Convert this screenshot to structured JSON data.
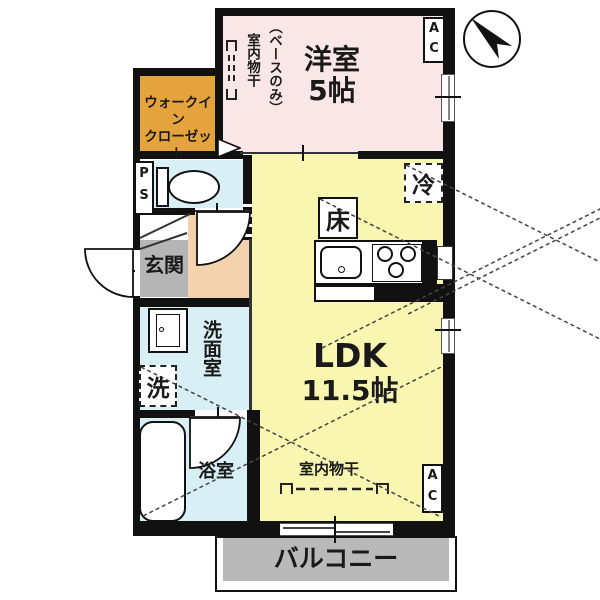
{
  "rooms": {
    "western": {
      "name": "洋室",
      "size": "5帖"
    },
    "wic": {
      "line1": "ウォークイン",
      "line2": "クローゼット"
    },
    "ldk": {
      "name": "LDK",
      "size": "11.5帖"
    },
    "entrance": {
      "name": "玄関"
    },
    "washroom": {
      "name": "洗面室"
    },
    "bathroom": {
      "name": "浴室"
    },
    "balcony": {
      "name": "バルコニー"
    }
  },
  "labels": {
    "ac": "AC",
    "ps": "PS",
    "fridge": "冷",
    "floor_storage": "床",
    "washer": "洗",
    "indoor_drying": "室内物干",
    "drying_note": "（ベースのみ）"
  },
  "icons": {
    "compass": "north-arrow-icon",
    "drying_rail": "drying-rail-icon",
    "door_swing": "door-swing-arc"
  },
  "colors": {
    "western_room": "#f9e7e7",
    "ldk": "#f8f6b0",
    "wic": "#e4a33c",
    "wet_area": "#d8f0f5",
    "hall": "#f3d3ae",
    "entrance": "#b5b5b5",
    "balcony": "#b9b9b9",
    "wall": "#111111"
  }
}
